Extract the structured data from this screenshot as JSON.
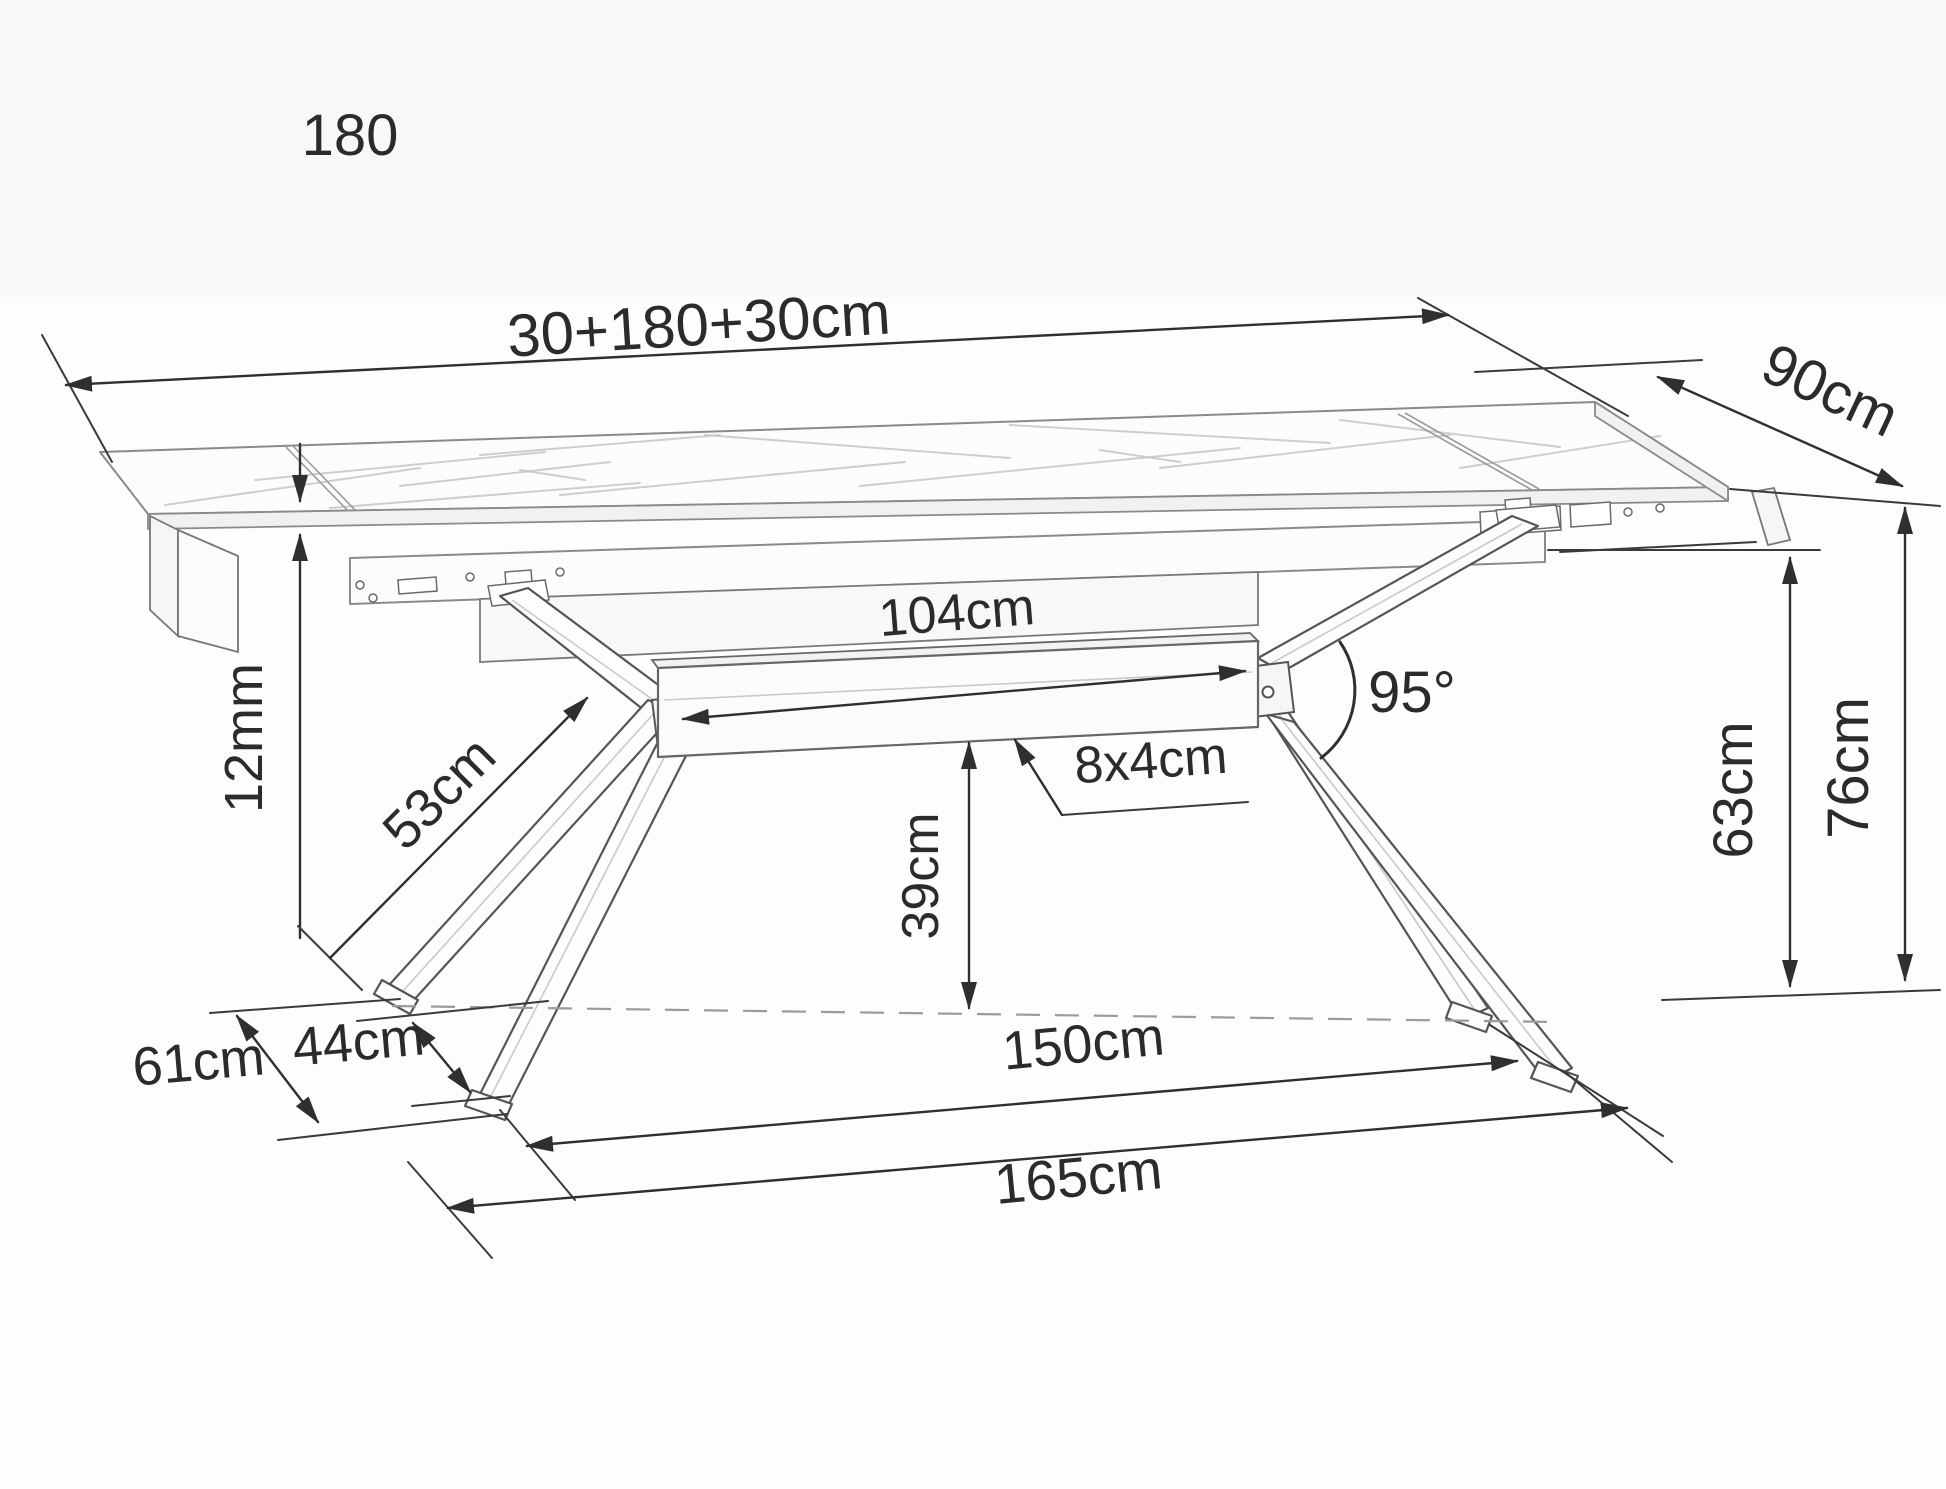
{
  "diagram": {
    "type": "furniture-dimension-drawing",
    "subject": "extendable dining table with ceramic marble top and spider metal legs",
    "labels": {
      "length_designation": "180",
      "total_length": "30+180+30cm",
      "width": "90cm",
      "top_thickness": "12mm",
      "leg_arm_length": "53cm",
      "beam_length": "104cm",
      "beam_profile": "8x4cm",
      "leg_angle": "95°",
      "beam_floor_clearance": "39cm",
      "frame_underside_height": "63cm",
      "table_height": "76cm",
      "base_depth_outer": "61cm",
      "base_depth_inner": "44cm",
      "feet_span_inner": "150cm",
      "feet_span_outer": "165cm"
    },
    "colors": {
      "dimension_line": "#2f2f2f",
      "drawing_line": "#6e6e6e",
      "marble_vein": "#c6c6c6",
      "text": "#2b2b2b",
      "background": "#fdfdfd"
    }
  }
}
